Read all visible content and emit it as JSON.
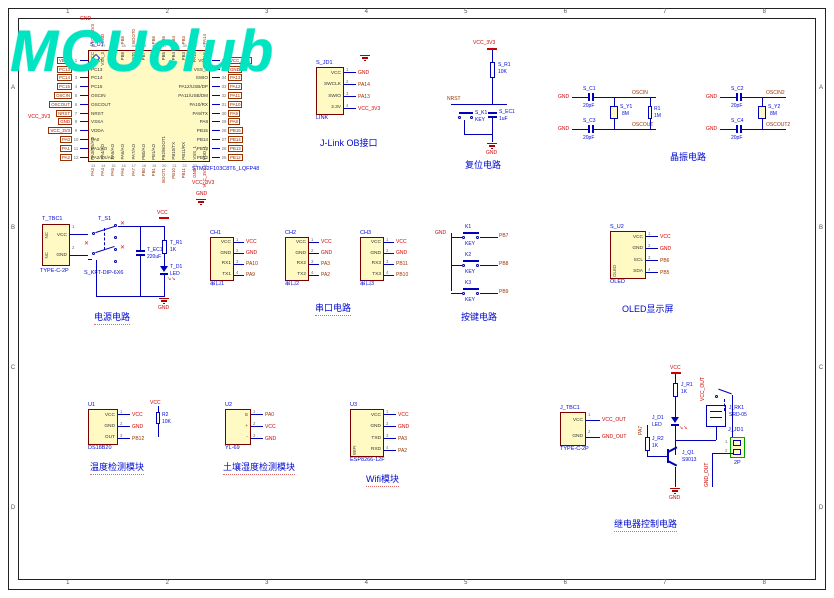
{
  "icons": {
    "no_erc": "✕",
    "led_arrows": "↘↘"
  },
  "sheet": {
    "columns": [
      "1",
      "2",
      "3",
      "4",
      "5",
      "6",
      "7",
      "8"
    ],
    "rows": [
      "A",
      "B",
      "C",
      "D"
    ]
  },
  "logo": {
    "text": "MCUclub"
  },
  "mcu": {
    "des": "S_U1",
    "part": "STM32F103C8T6_LQFP48",
    "left_pins": [
      {
        "net": "VBAT",
        "num": "1",
        "name": "VBAT"
      },
      {
        "net": "PC13",
        "num": "2",
        "name": "PC13"
      },
      {
        "net": "PC14",
        "num": "3",
        "name": "PC14"
      },
      {
        "net": "PC15",
        "num": "4",
        "name": "PC15"
      },
      {
        "net": "OSCIN",
        "num": "5",
        "name": "OSCIN"
      },
      {
        "net": "OSCOUT",
        "num": "6",
        "name": "OSCOUT"
      },
      {
        "net": "NRST",
        "num": "7",
        "name": "NRST"
      },
      {
        "net": "GND",
        "num": "8",
        "name": "VSSA"
      },
      {
        "net": "VCC_3V3",
        "num": "9",
        "name": "VDDA"
      },
      {
        "net": "PA0",
        "num": "10",
        "name": "PA0"
      },
      {
        "net": "PA1",
        "num": "11",
        "name": "PA1/AO"
      },
      {
        "net": "PA2",
        "num": "12",
        "name": "PA2/TX/AO"
      }
    ],
    "right_pins": [
      {
        "name": "VCC",
        "num": "36",
        "net": "VCC_3V3"
      },
      {
        "name": "VSS_2",
        "num": "35",
        "net": "GND"
      },
      {
        "name": "SWIO",
        "num": "34",
        "net": "PA13"
      },
      {
        "name": "PA12/USB/DP",
        "num": "33",
        "net": "PA12"
      },
      {
        "name": "PA11/USB/DM",
        "num": "32",
        "net": "PA11"
      },
      {
        "name": "PA10/RX",
        "num": "31",
        "net": "PA10"
      },
      {
        "name": "PA9/TX",
        "num": "30",
        "net": "PA9"
      },
      {
        "name": "PA8",
        "num": "29",
        "net": "PA8"
      },
      {
        "name": "PB15",
        "num": "28",
        "net": "PB15"
      },
      {
        "name": "PB14",
        "num": "27",
        "net": "PB14"
      },
      {
        "name": "PB13",
        "num": "26",
        "net": "PB13"
      },
      {
        "name": "PB12",
        "num": "25",
        "net": "PB12"
      }
    ],
    "top_pins": [
      {
        "name": "VCC",
        "num": "48",
        "net": "VCC_3V3"
      },
      {
        "name": "VSS_3",
        "num": "47",
        "net": "GND"
      },
      {
        "name": "PB9",
        "num": "46",
        "net": "PB9"
      },
      {
        "name": "PB8",
        "num": "45",
        "net": "PB8"
      },
      {
        "name": "BOOT0",
        "num": "44",
        "net": "BOOT0"
      },
      {
        "name": "PB7",
        "num": "43",
        "net": "PB7"
      },
      {
        "name": "PB6",
        "num": "42",
        "net": "PB6"
      },
      {
        "name": "PB5",
        "num": "41",
        "net": "PB5"
      },
      {
        "name": "PB4",
        "num": "40",
        "net": "PB4"
      },
      {
        "name": "PB3",
        "num": "39",
        "net": "PB3"
      },
      {
        "name": "PA15",
        "num": "38",
        "net": "PA15"
      },
      {
        "name": "SWCLK",
        "num": "37",
        "net": "PA14"
      }
    ],
    "bottom_pins": [
      {
        "name": "PA3/RX/AO",
        "num": "13",
        "net": "PA3"
      },
      {
        "name": "PA4/AO",
        "num": "14",
        "net": "PA4"
      },
      {
        "name": "PA5/AO",
        "num": "15",
        "net": "PA5"
      },
      {
        "name": "PA6/AO",
        "num": "16",
        "net": "PA6"
      },
      {
        "name": "PA7/AO",
        "num": "17",
        "net": "PA7"
      },
      {
        "name": "PB0/AO",
        "num": "18",
        "net": "PB0"
      },
      {
        "name": "PB1/AO",
        "num": "19",
        "net": "PB1"
      },
      {
        "name": "PB2/BOOT1",
        "num": "20",
        "net": "BOOT1"
      },
      {
        "name": "PB10/TX",
        "num": "21",
        "net": "PB10"
      },
      {
        "name": "PB11/RX",
        "num": "22",
        "net": "PB11"
      },
      {
        "name": "VSS_1",
        "num": "23",
        "net": "GND"
      },
      {
        "name": "VDD_1",
        "num": "24",
        "net": "VCC_3V3"
      }
    ],
    "pw": {
      "top_gnd": "GND",
      "left_vcc": "VCC_3V3",
      "bottom_vcc": "VCC_3V3",
      "bottom_gnd": "GND"
    }
  },
  "jlink": {
    "des": "S_JD1",
    "part": "LINK",
    "title": "J-Link OB接口",
    "gnd": "GND",
    "pins": [
      {
        "name": "VCC",
        "num": "1",
        "net": "GND"
      },
      {
        "name": "SWCLK",
        "num": "2",
        "net": "PA14"
      },
      {
        "name": "SWIO",
        "num": "3",
        "net": "PA13"
      },
      {
        "name": "3.3V",
        "num": "4",
        "net": "VCC_3V3"
      }
    ]
  },
  "reset": {
    "title": "复位电路",
    "vcc": "VCC_3V3",
    "net": "NRST",
    "res": {
      "des": "S_R1",
      "val": "10K"
    },
    "key": {
      "des": "S_K1",
      "val": "KEY"
    },
    "cap": {
      "des": "S_EC1",
      "val": "1uF"
    },
    "gnd": "GND"
  },
  "crystal": {
    "title": "晶振电路",
    "groups": [
      {
        "gnd1": "GND",
        "gnd2": "GND",
        "c1": {
          "des": "S_C1",
          "val": "20pF"
        },
        "c2": {
          "des": "S_C3",
          "val": "20pF"
        },
        "x": {
          "des": "S_Y1",
          "val": "8M"
        },
        "r": {
          "des": "R1",
          "val": "1M"
        },
        "n1": "OSCIN",
        "n2": "OSCOUT"
      },
      {
        "gnd1": "GND",
        "gnd2": "GND",
        "c1": {
          "des": "S_C2",
          "val": "20pF"
        },
        "c2": {
          "des": "S_C4",
          "val": "20pF"
        },
        "x": {
          "des": "S_Y2",
          "val": "8M"
        },
        "n1": "OSCIN2",
        "n2": "OSCOUT2"
      }
    ]
  },
  "power": {
    "title": "电源电路",
    "conn": {
      "des": "T_TBC1",
      "part": "TYPE-C-2P",
      "side": [
        "NC",
        "NC"
      ],
      "pins": [
        {
          "name": "VCC",
          "num": "1",
          "net": ""
        },
        {
          "name": "GND",
          "num": "2",
          "net": ""
        }
      ]
    },
    "sw": {
      "des": "T_S1",
      "part": "S_KFT-DIP-6X6"
    },
    "cap": {
      "des": "T_EC1",
      "val": "220uF"
    },
    "vcc": "VCC",
    "res": {
      "des": "T_R1",
      "val": "1K"
    },
    "led": {
      "des": "T_D1",
      "val": "LED"
    },
    "gnd": "GND"
  },
  "serial": {
    "title": "串口电路",
    "connectors": [
      {
        "des": "CH1",
        "part": "串口1",
        "pins": [
          {
            "name": "VCC",
            "num": "1",
            "net": "VCC"
          },
          {
            "name": "GND",
            "num": "2",
            "net": "GND"
          },
          {
            "name": "RX1",
            "num": "3",
            "net": "PA10"
          },
          {
            "name": "TX1",
            "num": "4",
            "net": "PA9"
          }
        ]
      },
      {
        "des": "CH2",
        "part": "串口2",
        "pins": [
          {
            "name": "VCC",
            "num": "1",
            "net": "VCC"
          },
          {
            "name": "GND",
            "num": "2",
            "net": "GND"
          },
          {
            "name": "RX2",
            "num": "3",
            "net": "PA3"
          },
          {
            "name": "TX2",
            "num": "4",
            "net": "PA2"
          }
        ]
      },
      {
        "des": "CH3",
        "part": "串口3",
        "pins": [
          {
            "name": "VCC",
            "num": "1",
            "net": "VCC"
          },
          {
            "name": "GND",
            "num": "2",
            "net": "GND"
          },
          {
            "name": "RX3",
            "num": "3",
            "net": "PB11"
          },
          {
            "name": "TX3",
            "num": "4",
            "net": "PB10"
          }
        ]
      }
    ]
  },
  "keys": {
    "title": "按键电路",
    "gnd": "GND",
    "items": [
      {
        "des": "K1",
        "part": "KEY",
        "net": "PB7"
      },
      {
        "des": "K2",
        "part": "KEY",
        "net": "PB8"
      },
      {
        "des": "K3",
        "part": "KEY",
        "net": "PB9"
      }
    ]
  },
  "oled": {
    "des": "S_U2",
    "part": "OLED",
    "side": "OLED",
    "title": "OLED显示屏",
    "pins": [
      {
        "name": "VCC",
        "num": "1",
        "net": "VCC"
      },
      {
        "name": "GND",
        "num": "2",
        "net": "GND"
      },
      {
        "name": "SCL",
        "num": "3",
        "net": "PB6"
      },
      {
        "name": "SDA",
        "num": "4",
        "net": "PB5"
      }
    ]
  },
  "temp": {
    "des": "U1",
    "part": "DS18B20",
    "title": "温度检测模块",
    "vcc": "VCC",
    "res": {
      "des": "R2",
      "val": "10K"
    },
    "pins": [
      {
        "name": "VCC",
        "num": "1",
        "net": "VCC"
      },
      {
        "name": "GND",
        "num": "2",
        "net": "GND"
      },
      {
        "name": "OUT",
        "num": "3",
        "net": "PB12"
      }
    ]
  },
  "soil": {
    "des": "U2",
    "part": "YL-69",
    "title": "土壤湿度检测模块",
    "pins": [
      {
        "name": "S",
        "num": "1",
        "net": "PA0"
      },
      {
        "name": "+",
        "num": "2",
        "net": "VCC"
      },
      {
        "name": "-",
        "num": "3",
        "net": "GND"
      }
    ]
  },
  "wifi": {
    "des": "U3",
    "part": "ESP8266-12F",
    "side": "WIFI",
    "title": "Wifi模块",
    "pins": [
      {
        "name": "VCC",
        "num": "1",
        "net": "VCC"
      },
      {
        "name": "GND",
        "num": "2",
        "net": "GND"
      },
      {
        "name": "TXD",
        "num": "3",
        "net": "PA3"
      },
      {
        "name": "RXD",
        "num": "4",
        "net": "PA2"
      }
    ]
  },
  "relay": {
    "title": "继电器控制电路",
    "conn": {
      "des": "J_TBC1",
      "part": "TYPE-C-2P",
      "pins": [
        {
          "name": "VCC",
          "num": "1",
          "net": "VCC_OUT"
        },
        {
          "name": "GND",
          "num": "2",
          "net": "GND_OUT"
        }
      ]
    },
    "vcc": "VCC",
    "r1": {
      "des": "J_R1",
      "val": "1K"
    },
    "led": {
      "des": "J_D1",
      "val": "LED"
    },
    "q": {
      "des": "J_Q1",
      "val": "S9013"
    },
    "r2": {
      "des": "J_R2",
      "val": "1K"
    },
    "base_net": "PA7",
    "rly": {
      "des": "J_RK1",
      "val": "SRD-05"
    },
    "out": {
      "des": "J_JD1",
      "part": "2P",
      "pins": [
        {
          "num": "1"
        },
        {
          "num": "2"
        }
      ]
    },
    "vcc_out": "VCC_OUT",
    "gnd_out": "GND_OUT",
    "gnd": "GND"
  }
}
